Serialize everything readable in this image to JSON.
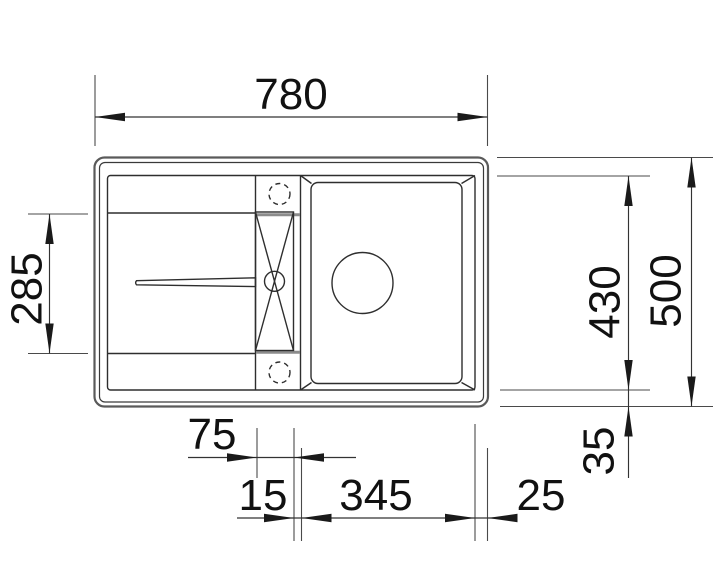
{
  "drawing": {
    "type": "technical-drawing",
    "subject": "kitchen sink top view with drainboard, tap strip and bowl",
    "background_color": "#ffffff",
    "line_color": "#2e2e2e",
    "dimension_labels": {
      "top_overall_width": "780",
      "left_drainer_depth": "285",
      "right_bowl_depth": "430",
      "right_overall_depth": "500",
      "right_bottom_offset": "35",
      "bottom_center_strip": "75",
      "bottom_rim_gap": "15",
      "bottom_bowl_width": "345",
      "bottom_right_margin": "25"
    }
  }
}
